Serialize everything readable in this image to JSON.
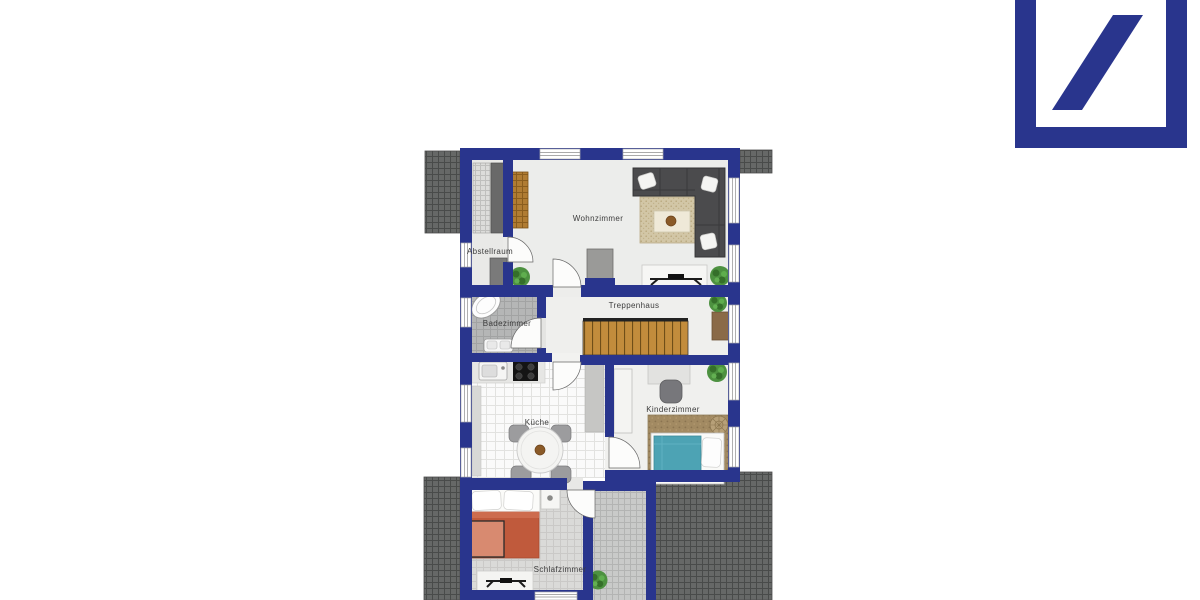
{
  "page": {
    "background": "#ffffff"
  },
  "branding": {
    "logo_name": "Deutsche Bank slash logo",
    "logo_color": "#29358d"
  },
  "floorplan": {
    "wall_color": "#29358d",
    "roof_color": "#666867",
    "rooms": [
      {
        "id": "wohnzimmer",
        "label": "Wohnzimmer"
      },
      {
        "id": "abstellraum",
        "label": "Abstellraum"
      },
      {
        "id": "treppenhaus",
        "label": "Treppenhaus"
      },
      {
        "id": "badezimmer",
        "label": "Badezimmer"
      },
      {
        "id": "kueche",
        "label": "Küche"
      },
      {
        "id": "kinderzimmer",
        "label": "Kinderzimmer"
      },
      {
        "id": "schlafzimmer",
        "label": "Schlafzimmer"
      }
    ]
  }
}
